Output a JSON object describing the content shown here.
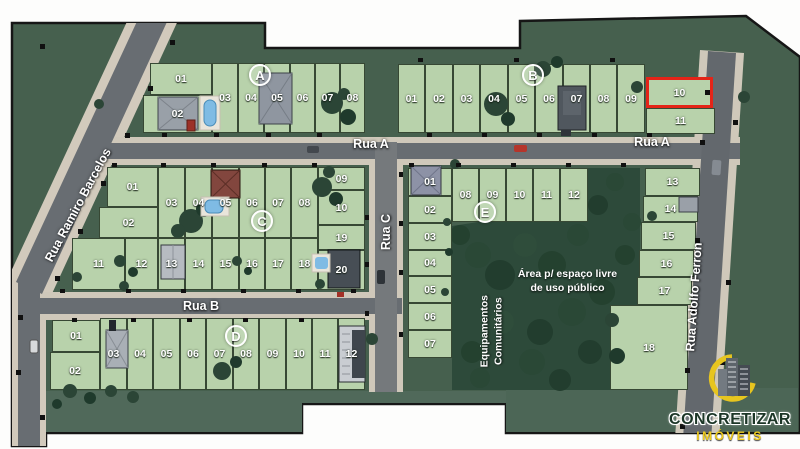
{
  "streets": {
    "rua_a": "Rua A",
    "rua_b": "Rua B",
    "rua_c": "Rua C",
    "ramiro": "Rua Ramiro Barcelos",
    "adolfo": "Rua Adolfo Ferron"
  },
  "areas": {
    "equipamentos": [
      "Equipamentos",
      "Comunitários"
    ],
    "espaco": [
      "Área p/ espaço livre",
      "de uso público"
    ]
  },
  "logo": {
    "name": "CONCRETIZAR",
    "tagline": "IMÓVEIS"
  },
  "palette": {
    "plan_bg": "#46604e",
    "lot_green": "#b8d2ab",
    "forest_green": "#2d4a3a",
    "road_asphalt": "#686d72",
    "road_sidewalk": "#cfc8ba",
    "highlight_red": "#e42418"
  },
  "highlighted_lot": {
    "block": "B",
    "lot": "10"
  },
  "blocks": [
    {
      "id": "A",
      "label": "A",
      "lots": [
        {
          "label": "01",
          "x": 150,
          "y": 63,
          "w": 62,
          "h": 32
        },
        {
          "label": "02",
          "x": 143,
          "y": 95,
          "w": 69,
          "h": 38
        },
        {
          "label": "03",
          "x": 212,
          "y": 63,
          "w": 26,
          "h": 70
        },
        {
          "label": "04",
          "x": 238,
          "y": 63,
          "w": 26,
          "h": 70
        },
        {
          "label": "05",
          "x": 264,
          "y": 63,
          "w": 26,
          "h": 70
        },
        {
          "label": "06",
          "x": 290,
          "y": 63,
          "w": 25,
          "h": 70
        },
        {
          "label": "07",
          "x": 315,
          "y": 63,
          "w": 25,
          "h": 70
        },
        {
          "label": "08",
          "x": 340,
          "y": 63,
          "w": 25,
          "h": 70
        }
      ]
    },
    {
      "id": "B",
      "label": "B",
      "lots": [
        {
          "label": "01",
          "x": 398,
          "y": 64,
          "w": 27,
          "h": 69
        },
        {
          "label": "02",
          "x": 425,
          "y": 64,
          "w": 28,
          "h": 69
        },
        {
          "label": "03",
          "x": 453,
          "y": 64,
          "w": 27,
          "h": 69
        },
        {
          "label": "04",
          "x": 480,
          "y": 64,
          "w": 28,
          "h": 69
        },
        {
          "label": "05",
          "x": 508,
          "y": 64,
          "w": 27,
          "h": 69
        },
        {
          "label": "06",
          "x": 535,
          "y": 64,
          "w": 28,
          "h": 69
        },
        {
          "label": "07",
          "x": 563,
          "y": 64,
          "w": 27,
          "h": 69
        },
        {
          "label": "08",
          "x": 590,
          "y": 64,
          "w": 27,
          "h": 69
        },
        {
          "label": "09",
          "x": 617,
          "y": 64,
          "w": 28,
          "h": 69
        },
        {
          "label": "10",
          "x": 646,
          "y": 77,
          "w": 67,
          "h": 31,
          "hl": true
        },
        {
          "label": "11",
          "x": 646,
          "y": 108,
          "w": 69,
          "h": 26
        }
      ]
    },
    {
      "id": "C",
      "label": "C",
      "lots": [
        {
          "label": "01",
          "x": 107,
          "y": 167,
          "w": 51,
          "h": 40
        },
        {
          "label": "02",
          "x": 99,
          "y": 207,
          "w": 59,
          "h": 31
        },
        {
          "label": "03",
          "x": 158,
          "y": 167,
          "w": 27,
          "h": 71
        },
        {
          "label": "04",
          "x": 185,
          "y": 167,
          "w": 27,
          "h": 71
        },
        {
          "label": "05",
          "x": 212,
          "y": 167,
          "w": 27,
          "h": 71
        },
        {
          "label": "06",
          "x": 239,
          "y": 167,
          "w": 26,
          "h": 71
        },
        {
          "label": "07",
          "x": 265,
          "y": 167,
          "w": 26,
          "h": 71
        },
        {
          "label": "08",
          "x": 291,
          "y": 167,
          "w": 27,
          "h": 71
        },
        {
          "label": "09",
          "x": 318,
          "y": 167,
          "w": 47,
          "h": 23
        },
        {
          "label": "10",
          "x": 318,
          "y": 190,
          "w": 47,
          "h": 35
        },
        {
          "label": "11",
          "x": 72,
          "y": 238,
          "w": 53,
          "h": 52
        },
        {
          "label": "12",
          "x": 125,
          "y": 238,
          "w": 33,
          "h": 52
        },
        {
          "label": "13",
          "x": 158,
          "y": 238,
          "w": 27,
          "h": 52
        },
        {
          "label": "14",
          "x": 185,
          "y": 238,
          "w": 27,
          "h": 52
        },
        {
          "label": "15",
          "x": 212,
          "y": 238,
          "w": 27,
          "h": 52
        },
        {
          "label": "16",
          "x": 239,
          "y": 238,
          "w": 26,
          "h": 52
        },
        {
          "label": "17",
          "x": 265,
          "y": 238,
          "w": 26,
          "h": 52
        },
        {
          "label": "18",
          "x": 291,
          "y": 238,
          "w": 27,
          "h": 52
        },
        {
          "label": "19",
          "x": 318,
          "y": 225,
          "w": 47,
          "h": 25
        },
        {
          "label": "20",
          "x": 318,
          "y": 250,
          "w": 47,
          "h": 40
        }
      ]
    },
    {
      "id": "D",
      "label": "D",
      "lots": [
        {
          "label": "01",
          "x": 52,
          "y": 320,
          "w": 48,
          "h": 32
        },
        {
          "label": "02",
          "x": 50,
          "y": 352,
          "w": 50,
          "h": 38
        },
        {
          "label": "03",
          "x": 100,
          "y": 318,
          "w": 27,
          "h": 72
        },
        {
          "label": "04",
          "x": 127,
          "y": 318,
          "w": 26,
          "h": 72
        },
        {
          "label": "05",
          "x": 153,
          "y": 318,
          "w": 27,
          "h": 72
        },
        {
          "label": "06",
          "x": 180,
          "y": 318,
          "w": 26,
          "h": 72
        },
        {
          "label": "07",
          "x": 206,
          "y": 318,
          "w": 27,
          "h": 72
        },
        {
          "label": "08",
          "x": 233,
          "y": 318,
          "w": 26,
          "h": 72
        },
        {
          "label": "09",
          "x": 259,
          "y": 318,
          "w": 27,
          "h": 72
        },
        {
          "label": "10",
          "x": 286,
          "y": 318,
          "w": 26,
          "h": 72
        },
        {
          "label": "11",
          "x": 312,
          "y": 318,
          "w": 26,
          "h": 72
        },
        {
          "label": "12",
          "x": 338,
          "y": 318,
          "w": 27,
          "h": 72
        }
      ]
    },
    {
      "id": "E",
      "label": "E",
      "lots": [
        {
          "label": "01",
          "x": 408,
          "y": 168,
          "w": 44,
          "h": 28
        },
        {
          "label": "02",
          "x": 408,
          "y": 196,
          "w": 44,
          "h": 27
        },
        {
          "label": "03",
          "x": 408,
          "y": 223,
          "w": 44,
          "h": 27
        },
        {
          "label": "04",
          "x": 408,
          "y": 250,
          "w": 44,
          "h": 26
        },
        {
          "label": "05",
          "x": 408,
          "y": 276,
          "w": 44,
          "h": 27
        },
        {
          "label": "06",
          "x": 408,
          "y": 303,
          "w": 44,
          "h": 27
        },
        {
          "label": "07",
          "x": 408,
          "y": 330,
          "w": 44,
          "h": 28
        },
        {
          "label": "08",
          "x": 452,
          "y": 168,
          "w": 27,
          "h": 54
        },
        {
          "label": "09",
          "x": 479,
          "y": 168,
          "w": 27,
          "h": 54
        },
        {
          "label": "10",
          "x": 506,
          "y": 168,
          "w": 27,
          "h": 54
        },
        {
          "label": "11",
          "x": 533,
          "y": 168,
          "w": 27,
          "h": 54
        },
        {
          "label": "12",
          "x": 560,
          "y": 168,
          "w": 28,
          "h": 54
        },
        {
          "label": "13",
          "x": 645,
          "y": 168,
          "w": 55,
          "h": 28
        },
        {
          "label": "14",
          "x": 643,
          "y": 196,
          "w": 55,
          "h": 26
        },
        {
          "label": "15",
          "x": 641,
          "y": 222,
          "w": 55,
          "h": 28
        },
        {
          "label": "16",
          "x": 639,
          "y": 250,
          "w": 55,
          "h": 27
        },
        {
          "label": "17",
          "x": 637,
          "y": 277,
          "w": 55,
          "h": 28
        },
        {
          "label": "18",
          "x": 610,
          "y": 305,
          "w": 78,
          "h": 85
        }
      ]
    }
  ]
}
